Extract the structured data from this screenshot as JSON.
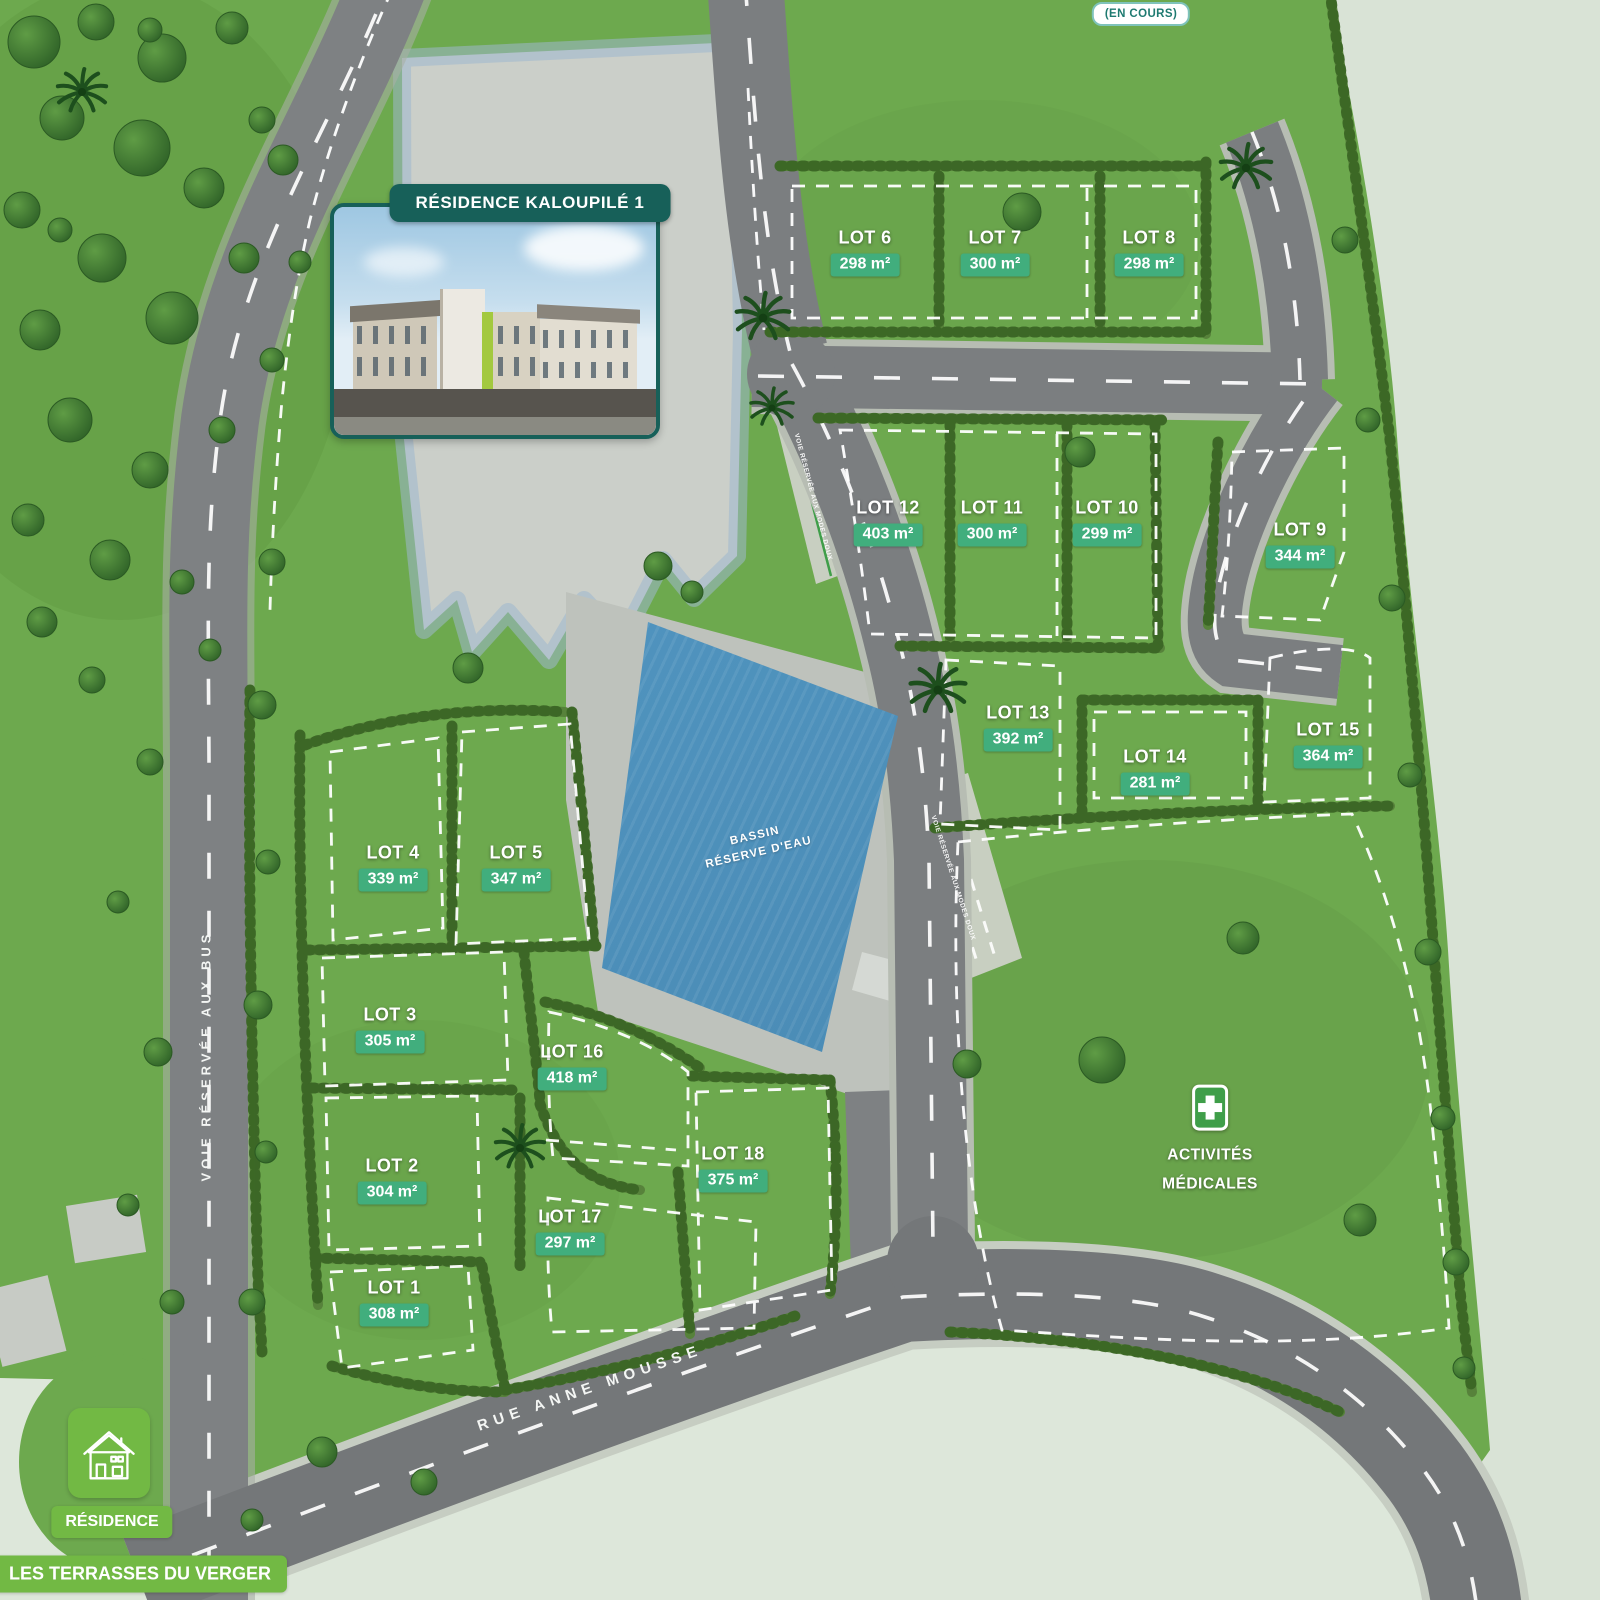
{
  "badges": {
    "en_cours": "(EN COURS)"
  },
  "kaloupile": {
    "title": "RÉSIDENCE KALOUPILÉ 1"
  },
  "lots": [
    {
      "name": "LOT 1",
      "area": "308 m²"
    },
    {
      "name": "LOT 2",
      "area": "304 m²"
    },
    {
      "name": "LOT 3",
      "area": "305 m²"
    },
    {
      "name": "LOT 4",
      "area": "339 m²"
    },
    {
      "name": "LOT 5",
      "area": "347 m²"
    },
    {
      "name": "LOT 6",
      "area": "298 m²"
    },
    {
      "name": "LOT 7",
      "area": "300 m²"
    },
    {
      "name": "LOT 8",
      "area": "298 m²"
    },
    {
      "name": "LOT 9",
      "area": "344 m²"
    },
    {
      "name": "LOT 10",
      "area": "299 m²"
    },
    {
      "name": "LOT 11",
      "area": "300 m²"
    },
    {
      "name": "LOT 12",
      "area": "403 m²"
    },
    {
      "name": "LOT 13",
      "area": "392 m²"
    },
    {
      "name": "LOT 14",
      "area": "281 m²"
    },
    {
      "name": "LOT 15",
      "area": "364 m²"
    },
    {
      "name": "LOT 16",
      "area": "418 m²"
    },
    {
      "name": "LOT 17",
      "area": "297 m²"
    },
    {
      "name": "LOT 18",
      "area": "375 m²"
    }
  ],
  "bassin": {
    "line1": "BASSIN",
    "line2": "RÉSERVE D'EAU"
  },
  "medical": {
    "line1": "ACTIVITÉS",
    "line2": "MÉDICALES"
  },
  "roads": {
    "rue_anne_mousse": "RUE ANNE MOUSSE",
    "voie_bus": "VOIE RÉSERVÉE AUX BUS",
    "path_label": "VOIE RÉSERVÉE AUX MODES DOUX"
  },
  "terrasses": {
    "line1": "RÉSIDENCE",
    "line2": "LES TERRASSES DU VERGER"
  },
  "colors": {
    "grass": "#6da94e",
    "pale": "#d9e3d6",
    "road": "#7b7e80",
    "water": "#5094bf",
    "lot_badge_green": "#41ae7d",
    "dark_teal": "#176059",
    "bright_green": "#72b944",
    "medical_green": "#3f9e49"
  }
}
